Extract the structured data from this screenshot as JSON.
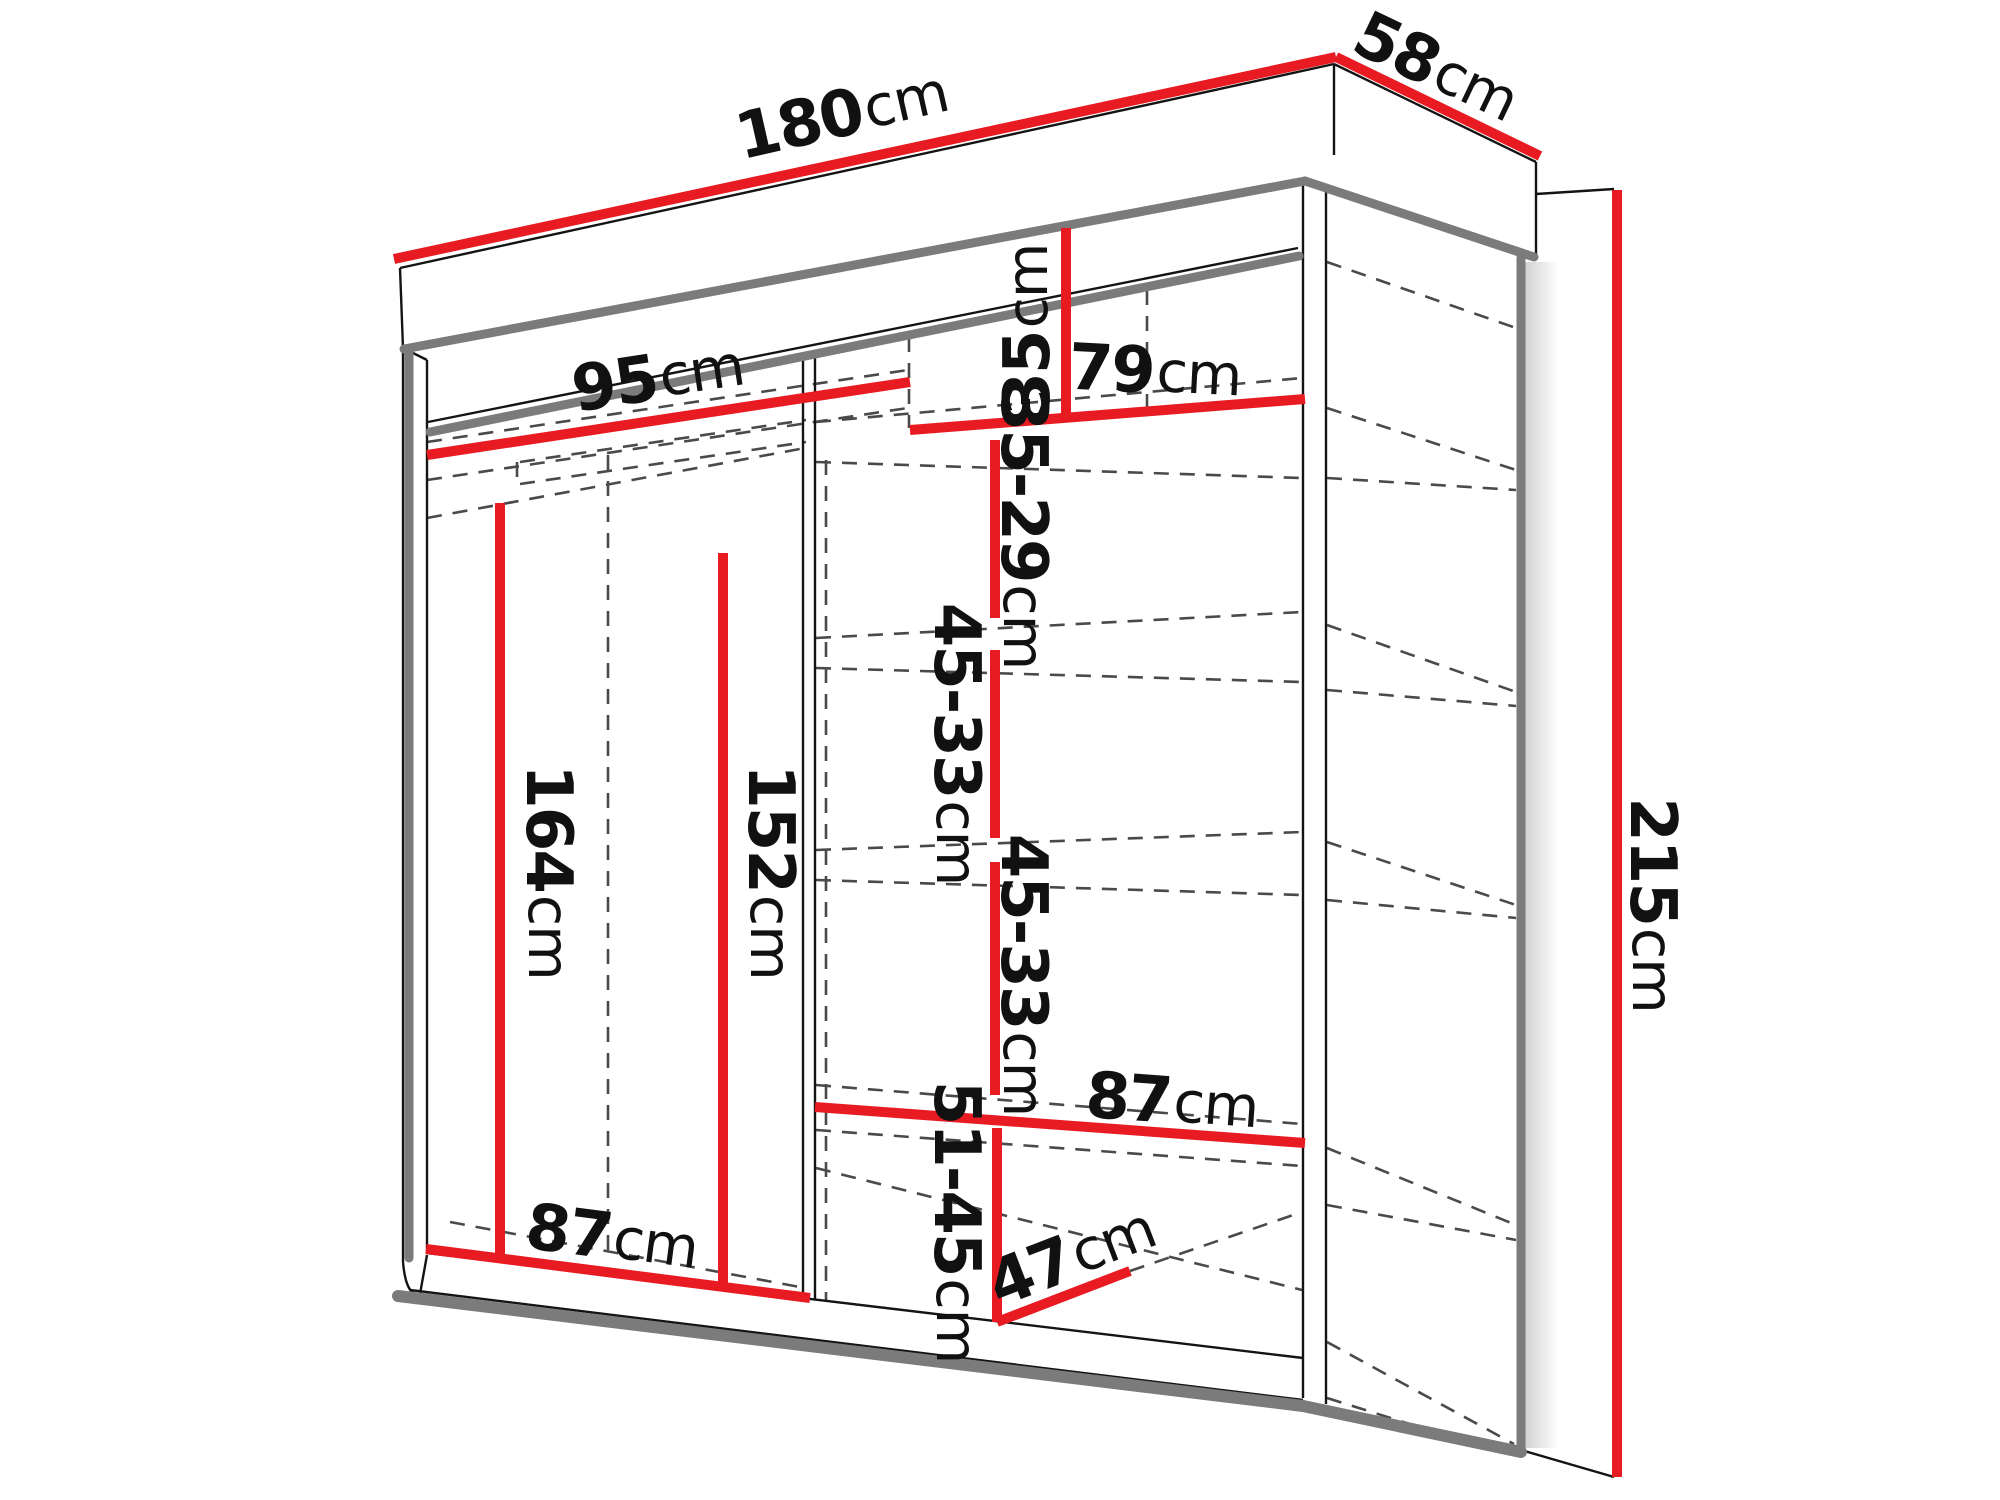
{
  "diagram": {
    "unit": "cm",
    "colors": {
      "dimension_red": "#e81b22",
      "outline": "#141414",
      "edge_gray": "#7b7b7b",
      "hidden_gray": "#4a4a4a",
      "background": "#ffffff",
      "label_text": "#111111"
    },
    "dimensions": [
      {
        "id": "width_total",
        "value": "180",
        "unit": "cm"
      },
      {
        "id": "depth_total",
        "value": "58",
        "unit": "cm"
      },
      {
        "id": "height_total",
        "value": "215",
        "unit": "cm"
      },
      {
        "id": "top_left_width",
        "value": "95",
        "unit": "cm"
      },
      {
        "id": "top_right_offset",
        "value": "35",
        "unit": "cm"
      },
      {
        "id": "top_right_width",
        "value": "79",
        "unit": "cm"
      },
      {
        "id": "gap_35_29",
        "value": "35-29",
        "unit": "cm"
      },
      {
        "id": "gap_45_33_a",
        "value": "45-33",
        "unit": "cm"
      },
      {
        "id": "gap_45_33_b",
        "value": "45-33",
        "unit": "cm"
      },
      {
        "id": "gap_51_45",
        "value": "51-45",
        "unit": "cm"
      },
      {
        "id": "left_height_164",
        "value": "164",
        "unit": "cm"
      },
      {
        "id": "left_height_152",
        "value": "152",
        "unit": "cm"
      },
      {
        "id": "bottom_left_width",
        "value": "87",
        "unit": "cm"
      },
      {
        "id": "right_shelf_width",
        "value": "87",
        "unit": "cm"
      },
      {
        "id": "bottom_depth",
        "value": "47",
        "unit": "cm"
      }
    ]
  }
}
